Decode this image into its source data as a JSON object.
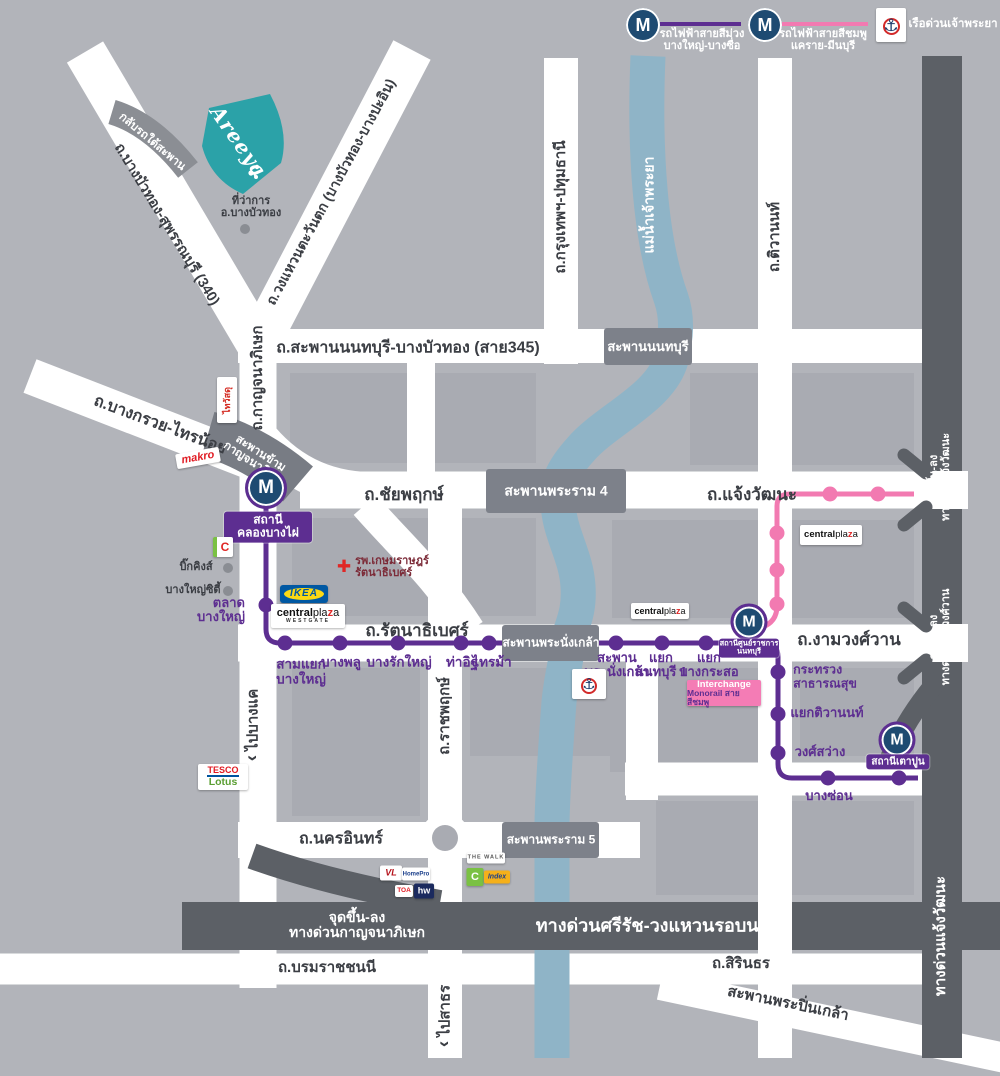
{
  "colors": {
    "purple_line": "#5d2e91",
    "pink_line": "#f27ab1",
    "mrt_navy": "#1e4b72",
    "areeya_teal": "#2ba2a8",
    "river_blue": "#8fb4c7",
    "expressway_dark": "#5c6066",
    "bridge_gray": "#7d818a",
    "road_white": "#ffffff",
    "background": "#b2b4ba",
    "block_gray": "#a9abb2",
    "label_dark": "#3b3e44"
  },
  "icons": {
    "anchor": "⚓",
    "chevron": "‹",
    "cross": "✚",
    "m_logo": "M"
  },
  "legend": {
    "m": "M",
    "purple1": "รถไฟฟ้าสายสีม่วง",
    "purple2": "บางใหญ่-บางซื่อ",
    "pink1": "รถไฟฟ้าสายสีชมพู",
    "pink2": "แคราย-มีนบุรี",
    "boat": "เรือด่วนเจ้าพระยา"
  },
  "roads": {
    "sai345": "ถ.สะพานนนทบุรี-บางบัวทอง (สาย345)",
    "chaiyaphruek": "ถ.ชัยพฤกษ์",
    "chaengwattana": "ถ.แจ้งวัฒนะ",
    "rattanathibet": "ถ.รัตนาธิเบศร์",
    "ngamwongwan": "ถ.งามวงศ์วาน",
    "nakhonin": "ถ.นครอินทร์",
    "borom": "ถ.บรมราชชนนี",
    "sirinthorn": "ถ.สิรินธร",
    "pinklao": "สะพานพระปิ่นเกล้า",
    "kanchanaphisek": "ถ.กาญจนาภิเษก",
    "krungthep_pathum": "ถ.กรุงเทพฯ-ปทุมธานี",
    "tiwanon": "ถ.ติวานนท์",
    "ratchaphruek": "ถ.ราชพฤกษ์",
    "bangkruai_sainoi": "ถ.บางกรวย-ไทรน้อย",
    "suphan340": "ถ.บางบัวทอง-สุพรรณบุรี (340)",
    "wongwaen_west": "ถ.วงแหวนตะวันตก (บางบัวทอง-บางปะอิน)",
    "river": "แม่น้ำเจ้าพระยา",
    "to_bangkhae": "ไปบางแค",
    "to_sathorn": "ไปสาธร"
  },
  "bridges": {
    "nonthaburi": "สะพานนนทบุรี",
    "rama4": "สะพานพระราม 4",
    "phranangklao": "สะพานพระนั่งเกล้า",
    "rama5": "สะพานพระราม 5",
    "cross1": "สะพานข้าม",
    "cross2": "กาญจนาภิเษก",
    "uturn": "กลับรถใต้สะพาน"
  },
  "expressways": {
    "sirat": "ทางด่วนศรีรัช-วงแหวนรอบนอก",
    "entry": "จุดขึ้น-ลง",
    "kanchana": "ทางด่วนกาญจนาภิเษก",
    "chaeng": "ทางด่วนแจ้งวัฒนะ",
    "ngam": "ทางด่วนงามวงศ์วาน",
    "chaeng_label": "ทางด่วนแจ้งวัฒนะ"
  },
  "stations": {
    "klongbangphai1": "สถานี",
    "klongbangphai2": "คลองบางไผ่",
    "talad1": "ตลาด",
    "talad2": "บางใหญ่",
    "samyaek1": "สามแยก",
    "samyaek2": "บางใหญ่",
    "bangphlu": "บางพลู",
    "bangrakyai": "บางรักใหญ่",
    "thait": "ท่าอิฐ",
    "saima": "ไทรม้า",
    "phranangklao1": "สะพาน",
    "phranangklao2": "พระนั่งเกล้า",
    "nonthaburi1a": "แยก",
    "nonthaburi1b": "นนทบุรี 1",
    "bangkraso1": "แยก",
    "bangkraso2": "บางกระสอ",
    "civic1": "สถานีศูนย์ราชการ",
    "civic2": "นนทบุรี",
    "moph1": "กระทรวง",
    "moph2": "สาธารณสุข",
    "yaek_tiwanon": "แยกติวานนท์",
    "wongsawang": "วงศ์สว่าง",
    "bangson": "บางซ่อน",
    "taopoon": "สถานีเตาปูน"
  },
  "places": {
    "district1": "ที่ว่าการ",
    "district2": "อ.บางบัวทอง",
    "bigkings": "บิ๊กคิงส์",
    "bangyaicity": "บางใหญ่ซิตี้",
    "hospital1": "รพ.เกษมราษฎร์",
    "hospital2": "รัตนาธิเบศร์",
    "interchange1": "Interchange",
    "interchange2": "Monorail สายสีชมพู"
  },
  "logos": {
    "areeya": "Areeya",
    "thaiwatsadu": "ไทวัสดุ",
    "makro": "makro",
    "ikea": "IKEA",
    "central": "central",
    "pla": "pla",
    "z": "z",
    "a": "a",
    "westgate": "WESTGATE",
    "tesco": "TESCO",
    "lotus": "Lotus",
    "bigc": "C",
    "vl": "VL",
    "homepro": "HomePro",
    "toa": "TOA",
    "hw": "hw",
    "thewalk": "THE WALK",
    "index": "Index"
  }
}
